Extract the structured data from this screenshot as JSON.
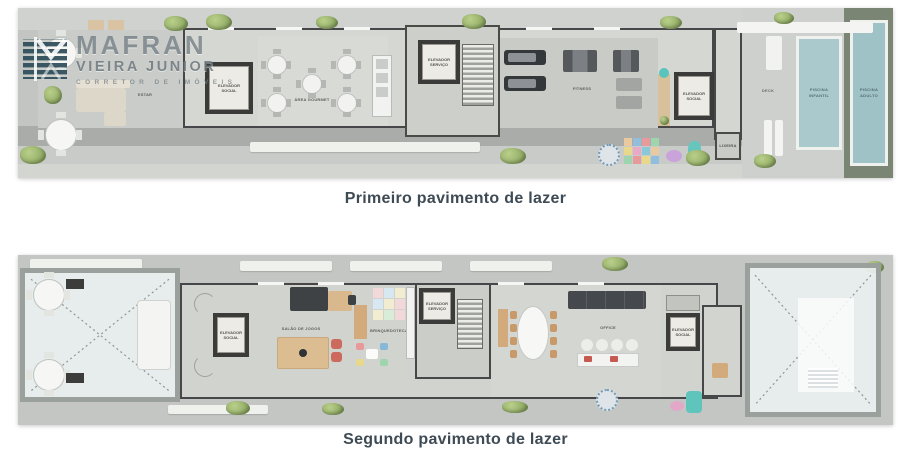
{
  "logo": {
    "brand": "MAFRAN",
    "brand2": "VIEIRA JUNIOR",
    "tagline": "CORRETOR DE IMÓVEIS"
  },
  "plan1": {
    "caption": "Primeiro pavimento de lazer",
    "labels": {
      "estar": "ESTAR",
      "elevador_social": "ELEVADOR SOCIAL",
      "area_gourmet": "ÁREA GOURMET",
      "elevador_servico": "ELEVADOR SERVIÇO",
      "fitness": "FITNESS",
      "elevador_social_2": "ELEVADOR SOCIAL",
      "lixeira": "LIXEIRA",
      "deck": "DECK",
      "piscina_infantil": "PISCINA INFANTIL",
      "piscina_adulto": "PISCINA ADULTO"
    }
  },
  "plan2": {
    "caption": "Segundo pavimento de lazer",
    "labels": {
      "elevador_social": "ELEVADOR SOCIAL",
      "salao_de_jogos": "SALÃO DE JOGOS",
      "brinquedoteca": "BRINQUEDOTECA",
      "elevador_servico": "ELEVADOR SERVIÇO",
      "office": "OFFICE",
      "elevador_social_2": "ELEVADOR SOCIAL"
    }
  }
}
